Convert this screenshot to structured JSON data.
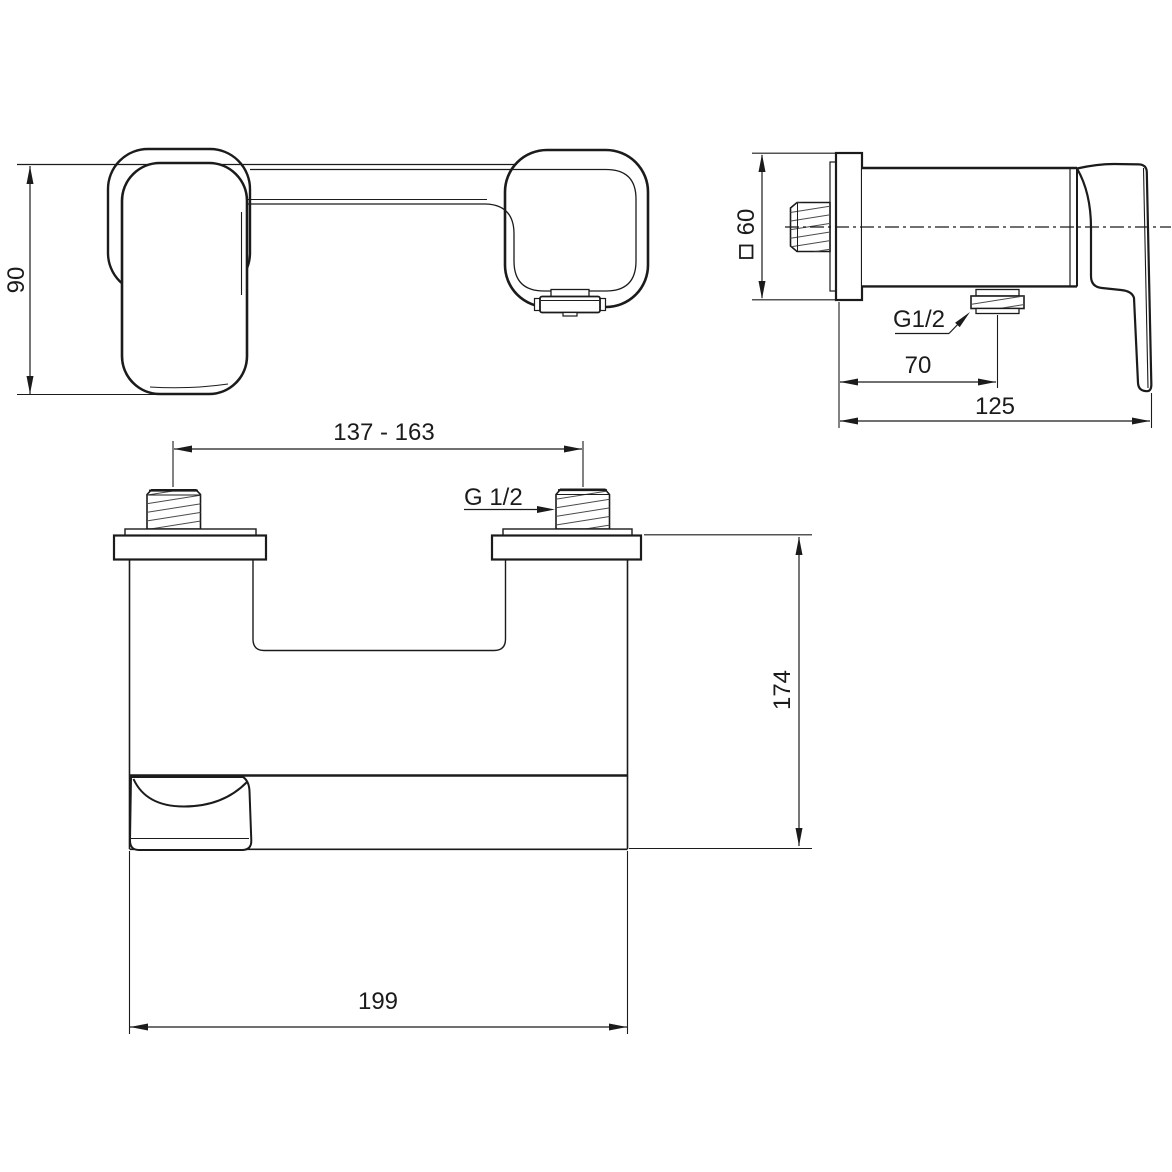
{
  "drawing": {
    "background": "#ffffff",
    "line_color": "#1b1b1b",
    "top_view": {
      "dim_height": "90"
    },
    "side_view": {
      "square_symbol": "□",
      "dim_square": "60",
      "label_outlet_thread": "G1/2",
      "dim_outlet_offset": "70",
      "dim_depth": "125"
    },
    "front_view": {
      "dim_inlet_spacing": "137 - 163",
      "label_inlet_thread": "G 1/2",
      "dim_height": "174",
      "dim_width": "199"
    }
  }
}
